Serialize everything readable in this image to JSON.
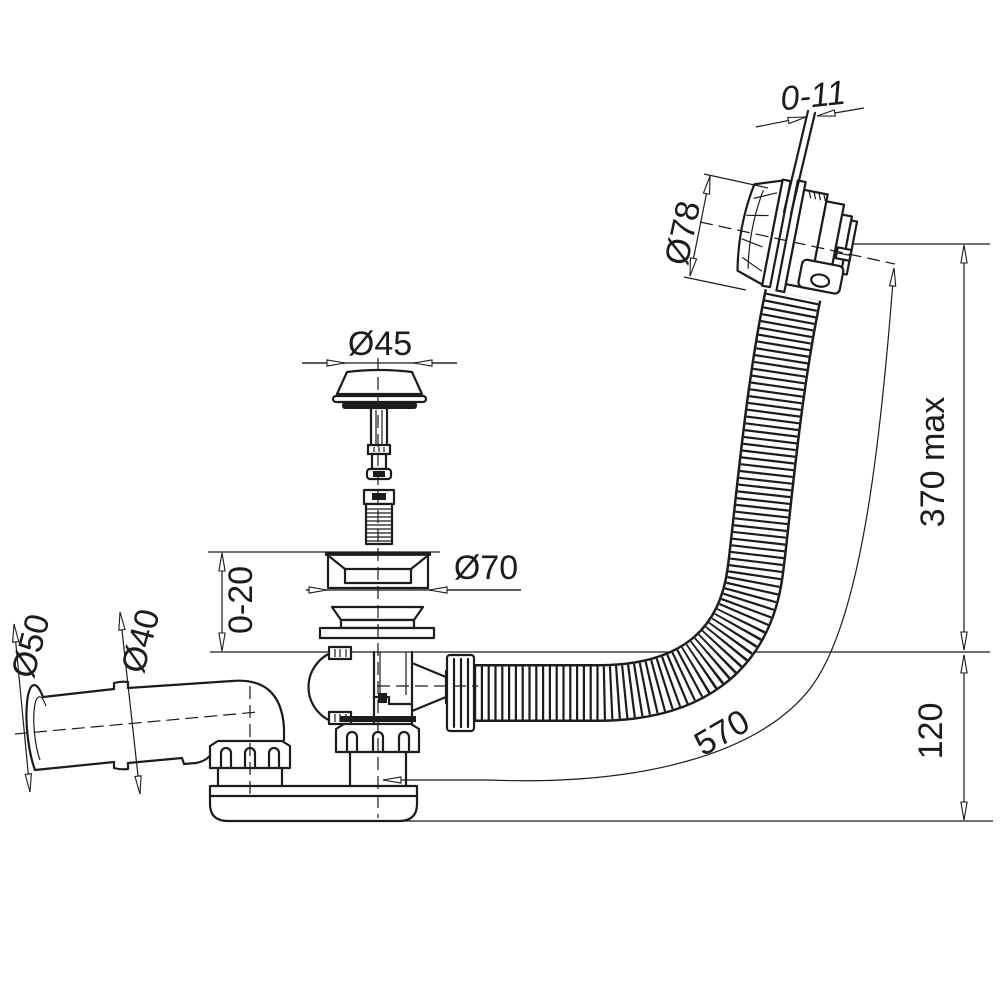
{
  "page": {
    "background": "#ffffff",
    "line_color": "#1c1c1c"
  },
  "dimensions": {
    "overflow_gap": "0-11",
    "overflow_head": "Ø78",
    "plug": "Ø45",
    "flange": "Ø70",
    "base_adjust": "0-20",
    "outlet_socket": "Ø50",
    "outlet_pipe": "Ø40",
    "height_max": "370 max",
    "trap_height": "120",
    "hose_length": "570"
  }
}
